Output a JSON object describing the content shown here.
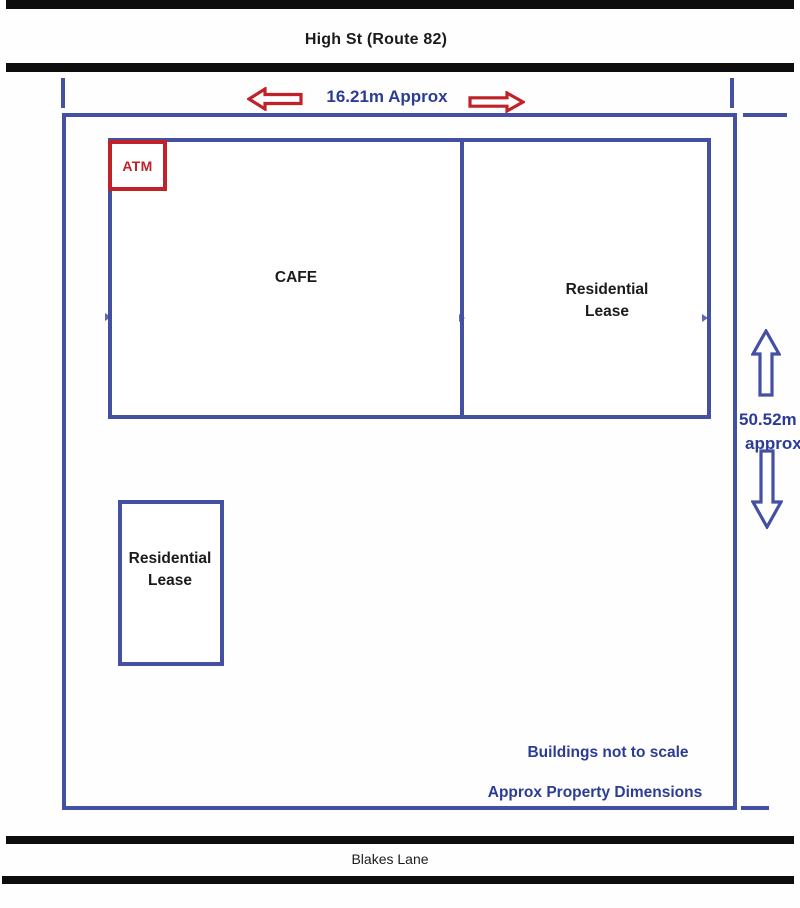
{
  "title": "Property sketch plan",
  "colors": {
    "line_blue": "#4450a2",
    "text_blue": "#2c3c96",
    "accent_red": "#bf2329",
    "road_black": "#0d0d0d",
    "text_black": "#1b1b1b"
  },
  "streets": {
    "top": "High St (Route 82)",
    "bottom": "Blakes Lane"
  },
  "dimensions": {
    "width_label": "16.21m Approx",
    "height_value": "50.52m",
    "height_qualifier": "approx"
  },
  "buildings": {
    "atm_label": "ATM",
    "cafe_label": "CAFE",
    "residential_right": {
      "line1": "Residential",
      "line2": "Lease"
    },
    "residential_lower": {
      "line1": "Residential",
      "line2": "Lease"
    }
  },
  "notes": {
    "scale_note": "Buildings not to scale",
    "dimension_note": "Approx Property Dimensions"
  },
  "icons": {
    "arrow_left": "red outline block arrow pointing left",
    "arrow_right": "red outline block arrow pointing right",
    "arrow_up": "blue outline block arrow pointing up",
    "arrow_down": "blue outline block arrow pointing down"
  }
}
